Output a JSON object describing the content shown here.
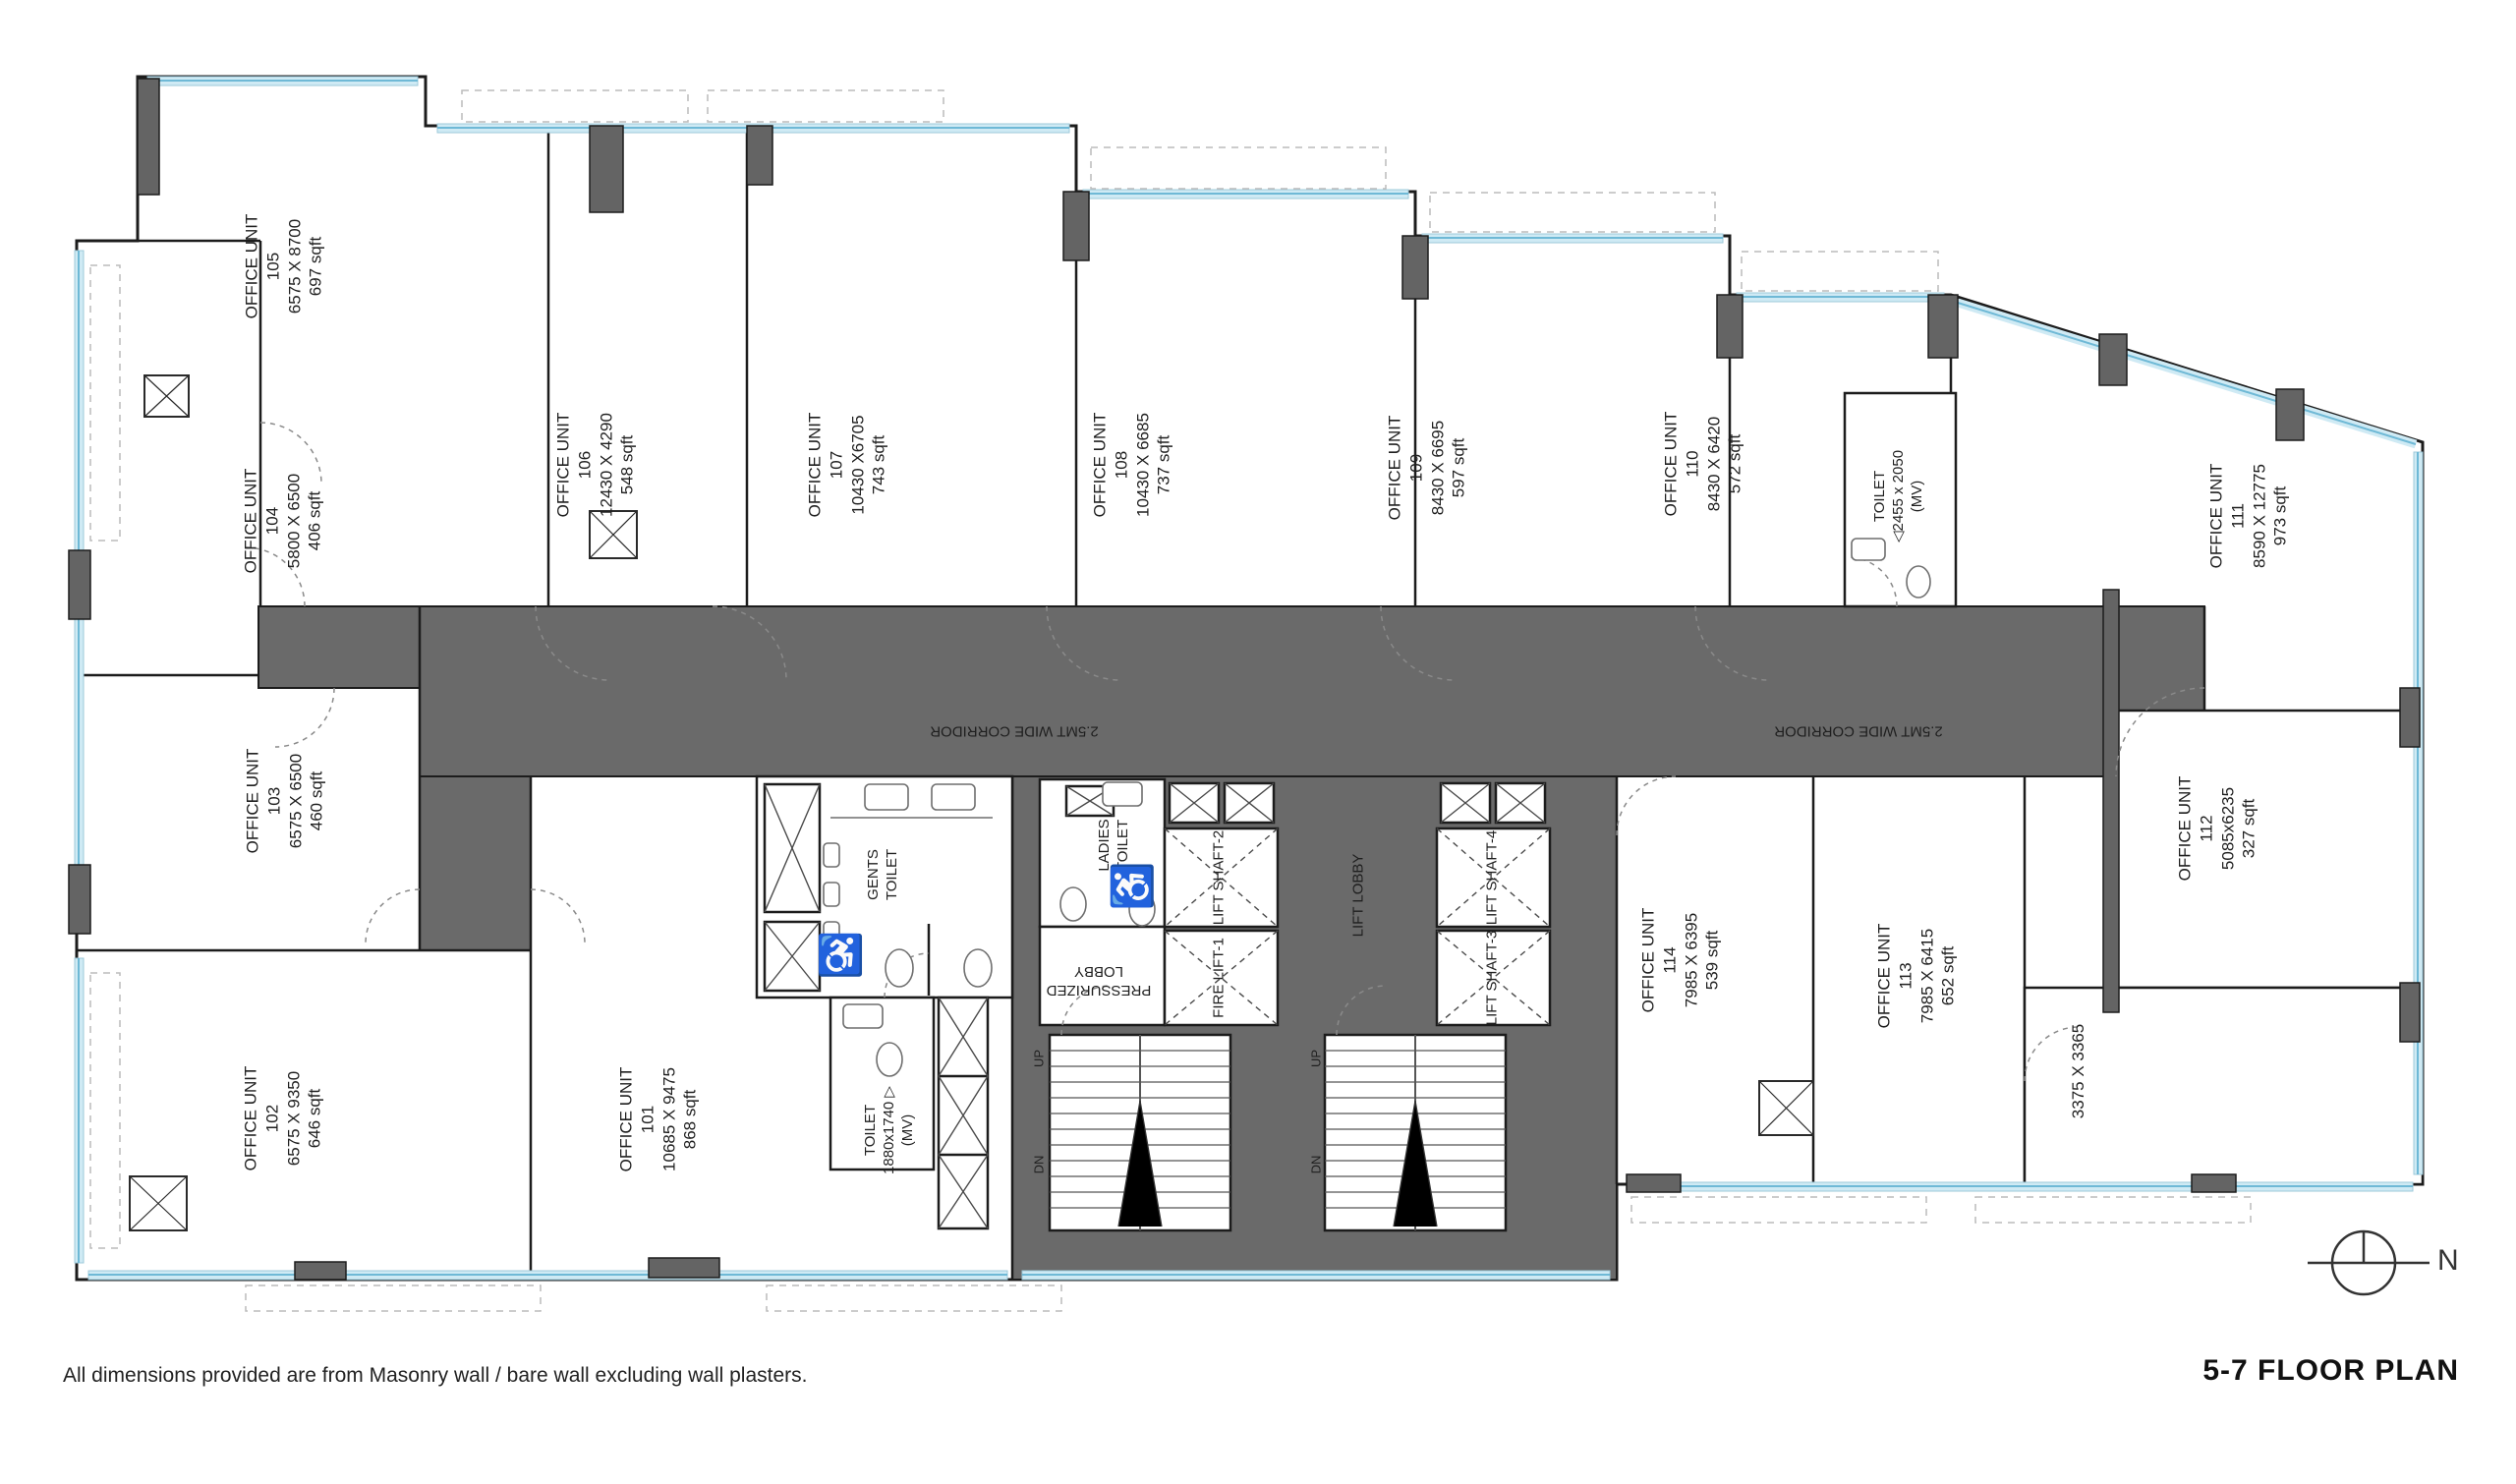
{
  "title": "5-7 FLOOR PLAN",
  "note": "All dimensions provided are from Masonry wall / bare wall excluding wall plasters.",
  "north_label": "N",
  "corridor": {
    "label": "2.5MT WIDE CORRIDOR"
  },
  "colors": {
    "corridor_fill": "#6a6a6a",
    "wall": "#1c1c1c",
    "glass": "#cfeaf4",
    "glass_line": "#6fb9d6",
    "accent_blue": "#1b87b8"
  },
  "units": [
    {
      "name": "OFFICE UNIT",
      "number": "101",
      "dims": "10685  X 9475",
      "area": "868 sqft"
    },
    {
      "name": "OFFICE UNIT",
      "number": "102",
      "dims": "6575 X 9350",
      "area": "646 sqft"
    },
    {
      "name": "OFFICE UNIT",
      "number": "103",
      "dims": "6575 X 6500",
      "area": "460 sqft"
    },
    {
      "name": "OFFICE UNIT",
      "number": "104",
      "dims": "5800 X 6500",
      "area": "406 sqft"
    },
    {
      "name": "OFFICE UNIT",
      "number": "105",
      "dims": "6575 X 8700",
      "area": "697 sqft"
    },
    {
      "name": "OFFICE UNIT",
      "number": "106",
      "dims": "12430 X 4290",
      "area": "548 sqft"
    },
    {
      "name": "OFFICE UNIT",
      "number": "107",
      "dims": "10430 X6705",
      "area": "743 sqft"
    },
    {
      "name": "OFFICE UNIT",
      "number": "108",
      "dims": "10430 X 6685",
      "area": "737 sqft"
    },
    {
      "name": "OFFICE UNIT",
      "number": "109",
      "dims": "8430 X 6695",
      "area": "597 sqft"
    },
    {
      "name": "OFFICE UNIT",
      "number": "110",
      "dims": "8430 X 6420",
      "area": "572 sqft"
    },
    {
      "name": "OFFICE UNIT",
      "number": "111",
      "dims": "8590 X 12775",
      "area": "973 sqft"
    },
    {
      "name": "OFFICE UNIT",
      "number": "112",
      "dims": "5085x6235",
      "area": "327 sqft"
    },
    {
      "name": "OFFICE UNIT",
      "number": "113",
      "dims": "7985 X 6415",
      "area": "652 sqft"
    },
    {
      "name": "OFFICE UNIT",
      "number": "114",
      "dims": "7985 X 6395",
      "area": "539 sqft"
    }
  ],
  "core": {
    "gents_toilet": {
      "line1": "GENTS",
      "line2": "TOILET"
    },
    "ladies_toilet": {
      "line1": "LADIES",
      "line2": "TOILET"
    },
    "toilet_small": {
      "name": "TOILET",
      "dims": "1880x1740 ▷",
      "vent": "(MV)"
    },
    "toilet_right": {
      "name": "TOILET",
      "dims": "◁2455 x 2050",
      "vent": "(MV)"
    },
    "pressurized_lobby": {
      "line1": "PRESSURIZED",
      "line2": "LOBBY"
    },
    "lift_lobby": "LIFT LOBBY",
    "fire_lift_1": "FIRE LIFT-1",
    "lift_shaft_2": "LIFT SHAFT-2",
    "lift_shaft_3": "LIFT SHAFT-3",
    "lift_shaft_4": "LIFT SHAFT-4",
    "stair_up": "UP",
    "stair_dn": "DN",
    "corner_dims": "3375 X 3365",
    "accessible_icon": "♿"
  }
}
